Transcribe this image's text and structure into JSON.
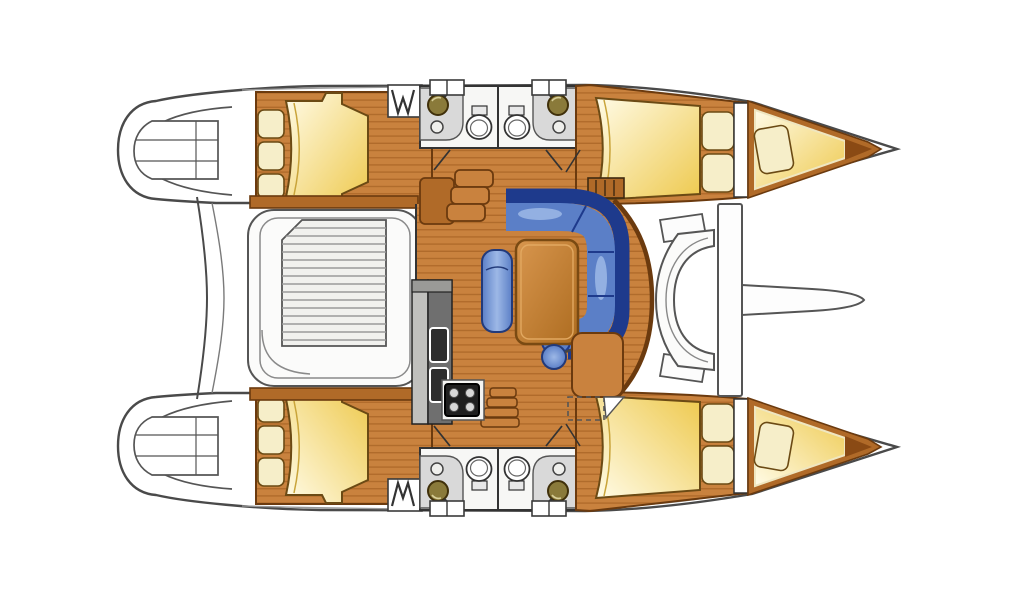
{
  "colors": {
    "wood": "#c9823e",
    "woodStripe": "#a05c1e",
    "woodTrim": "#b06a28",
    "woodDark": "#8a4a14",
    "woodLine": "#6b3a0e",
    "outline": "#3a3a3a",
    "hullLine": "#4a4a4a",
    "bedLight": "#fffbe6",
    "bedDeep": "#eec94e",
    "pillow": "#f6eec9",
    "pillowLine": "#6b4a14",
    "sofaDark": "#1e3a8c",
    "sofaMid": "#5b7fc7",
    "sofaLight": "#9db8e6",
    "counterGray": "#d9d9d9",
    "unitGray": "#6f6f6f",
    "unitGrayLight": "#c0c0bd",
    "handleDark": "#2e2e2e",
    "benchWhite": "#fbfbfa",
    "slatLine": "#9a9a9a",
    "deckWhite": "#ffffff",
    "sinkBronze": "#8a7a3a",
    "tableLight": "#d8964e",
    "tableDark": "#ad6c20"
  }
}
